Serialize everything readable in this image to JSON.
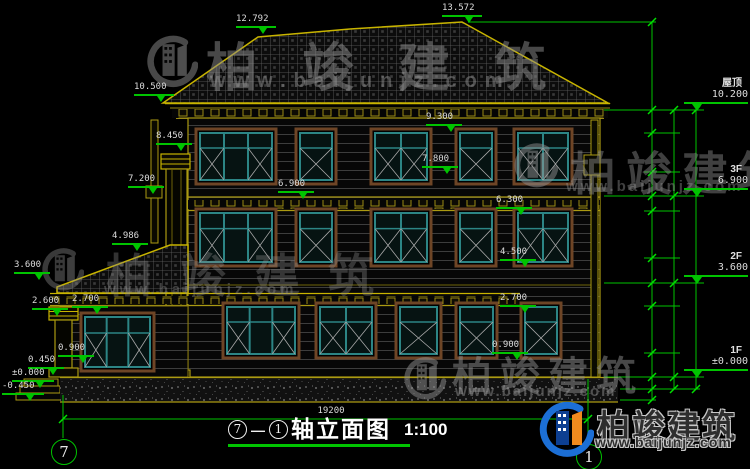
{
  "title": {
    "axis_from": "7",
    "axis_to": "1",
    "name": "轴立面图",
    "scale": "1:100"
  },
  "ground_dim": "19200",
  "axes": {
    "left": "7",
    "right": "1"
  },
  "watermark": {
    "brand": "柏竣建筑",
    "url": "www.baijunjz.com"
  },
  "floors": [
    {
      "name": "屋顶",
      "elev": "10.200",
      "x": 684,
      "y": 78
    },
    {
      "name": "3F",
      "elev": "6.900",
      "x": 684,
      "y": 164
    },
    {
      "name": "2F",
      "elev": "3.600",
      "x": 684,
      "y": 251
    },
    {
      "name": "1F",
      "elev": "±0.000",
      "x": 684,
      "y": 345
    }
  ],
  "markers": [
    {
      "t": "13.572",
      "x": 442,
      "y": 4,
      "w": 40
    },
    {
      "t": "12.792",
      "x": 236,
      "y": 15,
      "w": 40
    },
    {
      "t": "10.500",
      "x": 134,
      "y": 83,
      "w": 40
    },
    {
      "t": "9.300",
      "x": 426,
      "y": 113,
      "w": 36
    },
    {
      "t": "8.450",
      "x": 156,
      "y": 132,
      "w": 36
    },
    {
      "t": "7.800",
      "x": 422,
      "y": 155,
      "w": 36
    },
    {
      "t": "7.200",
      "x": 128,
      "y": 175,
      "w": 36
    },
    {
      "t": "6.900",
      "x": 278,
      "y": 180,
      "w": 36
    },
    {
      "t": "6.300",
      "x": 496,
      "y": 196,
      "w": 36
    },
    {
      "t": "4.986",
      "x": 112,
      "y": 232,
      "w": 36
    },
    {
      "t": "4.500",
      "x": 500,
      "y": 248,
      "w": 36
    },
    {
      "t": "3.600",
      "x": 14,
      "y": 261,
      "w": 36
    },
    {
      "t": "2.700",
      "x": 500,
      "y": 294,
      "w": 36
    },
    {
      "t": "2.600",
      "x": 32,
      "y": 297,
      "w": 36
    },
    {
      "t": "2.700",
      "x": 72,
      "y": 295,
      "w": 36
    },
    {
      "t": "0.900",
      "x": 492,
      "y": 341,
      "w": 36
    },
    {
      "t": "0.900",
      "x": 58,
      "y": 344,
      "w": 36
    },
    {
      "t": "0.450",
      "x": 28,
      "y": 356,
      "w": 36
    },
    {
      "t": "±0.000",
      "x": 12,
      "y": 369,
      "w": 42
    },
    {
      "t": "-0.450",
      "x": 2,
      "y": 382,
      "w": 42
    }
  ],
  "chain_values": [
    {
      "v": "3372",
      "x": 645,
      "y": 66
    },
    {
      "v": "900",
      "x": 645,
      "y": 121
    },
    {
      "v": "1500",
      "x": 645,
      "y": 152
    },
    {
      "v": "900",
      "x": 645,
      "y": 184
    },
    {
      "v": "600",
      "x": 645,
      "y": 203
    },
    {
      "v": "1800",
      "x": 645,
      "y": 234
    },
    {
      "v": "900",
      "x": 645,
      "y": 270
    },
    {
      "v": "900",
      "x": 645,
      "y": 294
    },
    {
      "v": "1800",
      "x": 645,
      "y": 329
    },
    {
      "v": "900",
      "x": 645,
      "y": 365
    },
    {
      "v": "450",
      "x": 645,
      "y": 388
    },
    {
      "v": "3300",
      "x": 667,
      "y": 153
    },
    {
      "v": "3300",
      "x": 667,
      "y": 239
    },
    {
      "v": "3600",
      "x": 667,
      "y": 330
    },
    {
      "v": "450",
      "x": 667,
      "y": 383
    },
    {
      "v": "10650",
      "x": 690,
      "y": 250
    }
  ]
}
